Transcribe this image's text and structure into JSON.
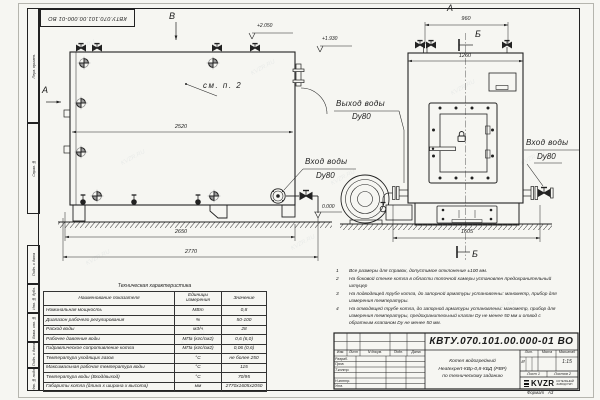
{
  "watermark": "KVZR.RU",
  "sheet": {
    "doc_number": "КВТУ.070.101.00.000-01 ВО",
    "format_label": "Формат",
    "format_value": "А3",
    "margin_labels": [
      "Перв. примен.",
      "Справ. №",
      "Подп. и дата",
      "Инв. № дубл.",
      "Взам. инв. №",
      "Подп. и дата",
      "Инв. № подл."
    ]
  },
  "drawing": {
    "section_v": "В",
    "section_a_side": "А",
    "section_a_front": "А",
    "section_b_top": "Б",
    "section_b_bottom": "Б",
    "note_ref": "см. п. 2",
    "elevations": {
      "top": "+2.050",
      "mid": "+1.930",
      "zero": "0.000"
    },
    "dims": {
      "side_inner": "2520",
      "side_mid": "2650",
      "side_total": "2770",
      "front_top": "960",
      "front_body": "1260",
      "front_base": "1605"
    },
    "labels": {
      "outlet": "Выход воды",
      "outlet_dn": "Dy80",
      "inlet_side": "Вход воды",
      "inlet_side_dn": "Dy80",
      "inlet_front": "Вход воды",
      "inlet_front_dn": "Dy80"
    }
  },
  "notes": [
    {
      "num": "1",
      "text": "Все размеры для справок, допустимое отклонение ±100 мм."
    },
    {
      "num": "2",
      "text": "На боковой стенке котла в области топочной камеры установлен предохранительный штуцер"
    },
    {
      "num": "3",
      "text": "На подводящей трубе котла, до запорной арматуры установлены: манометр, прибор для измерения температуры."
    },
    {
      "num": "4",
      "text": "На отводящей трубе котла, до запорной арматуры установлены: манометр, прибор для измерения температуры, предохранительный клапан Dу не менее 50 мм и отвод с обратным клапаном Dу не менее 50 мм."
    }
  ],
  "tech_table": {
    "title": "Техническая характеристика",
    "headers": [
      "Наименование показателя",
      "Единицы измерения",
      "Значение"
    ],
    "rows": [
      {
        "name": "Номинальная мощность",
        "unit": "МВт",
        "value": "0,8"
      },
      {
        "name": "Диапазон рабочего регулирования",
        "unit": "%",
        "value": "50-100"
      },
      {
        "name": "Расход воды",
        "unit": "м3/ч",
        "value": "28"
      },
      {
        "name": "Рабочее давление воды",
        "unit": "МПа (кгс/см2)",
        "value": "0,6 (6,0)"
      },
      {
        "name": "Гидравлическое сопротивление котла",
        "unit": "МПа (кгс/см2)",
        "value": "0,06 (0,6)"
      },
      {
        "name": "Температура уходящих газов",
        "unit": "°С",
        "value": "не более 250"
      },
      {
        "name": "Максимальная рабочая температура воды",
        "unit": "°С",
        "value": "115"
      },
      {
        "name": "Температура воды (Вход/выход)",
        "unit": "°С",
        "value": "70/95"
      },
      {
        "name": "Габариты котла (длина х ширина х высота)",
        "unit": "мм",
        "value": "2770х1605х2050"
      }
    ]
  },
  "title_block": {
    "columns": [
      "Изм.",
      "Лист",
      "N докум.",
      "Подп.",
      "Дата"
    ],
    "roles": [
      "Разраб.",
      "Пров.",
      "Т.контр.",
      "Н.контр.",
      "Утв."
    ],
    "product_lines": [
      "Котел водогрейный",
      "Heatexpert-КВр-0,8-КБД (РВР)",
      "по техническому заданию"
    ],
    "lit_label": "Лит.",
    "mass_label": "Масса",
    "scale_label": "Масштаб",
    "lit_value": "И",
    "scale_value": "1:15",
    "sheet_info": "Лист 1",
    "sheets_info": "Листов 2",
    "logo": "KVZR",
    "logo_sub1": "КОТЕЛЬНЫЙ",
    "logo_sub2": "ЗАВОД РЭП"
  }
}
